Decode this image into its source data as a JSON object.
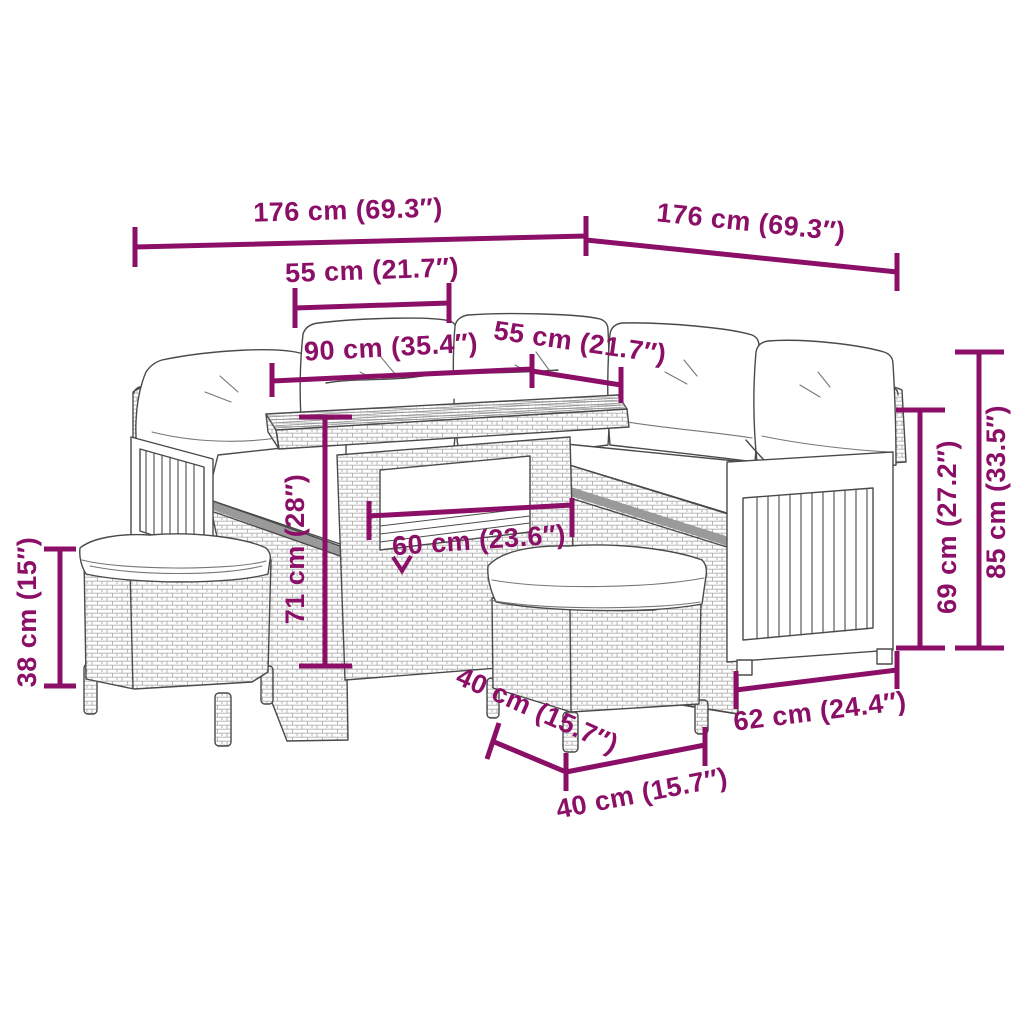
{
  "diagram": {
    "kind": "furniture-dimension-line-drawing",
    "background_color": "#ffffff",
    "accent_color": "#8b0f66",
    "drawing_color": "#4a4a4a"
  },
  "dims": {
    "sofa_total_width_left": "176 cm (69.3″)",
    "sofa_total_width_right": "176 cm (69.3″)",
    "seat_section_width": "55 cm (21.7″)",
    "table_length": "90 cm (35.4″)",
    "table_width": "55 cm (21.7″)",
    "table_height": "71 cm (28″)",
    "table_inner_width": "60 cm (23.6″)",
    "stool_height": "38 cm (15″)",
    "stool_depth": "40 cm (15.7″)",
    "stool_width": "40 cm (15.7″)",
    "armrest_section_width": "62 cm (24.4″)",
    "seat_height": "69 cm (27.2″)",
    "back_height": "85 cm (33.5″)"
  }
}
